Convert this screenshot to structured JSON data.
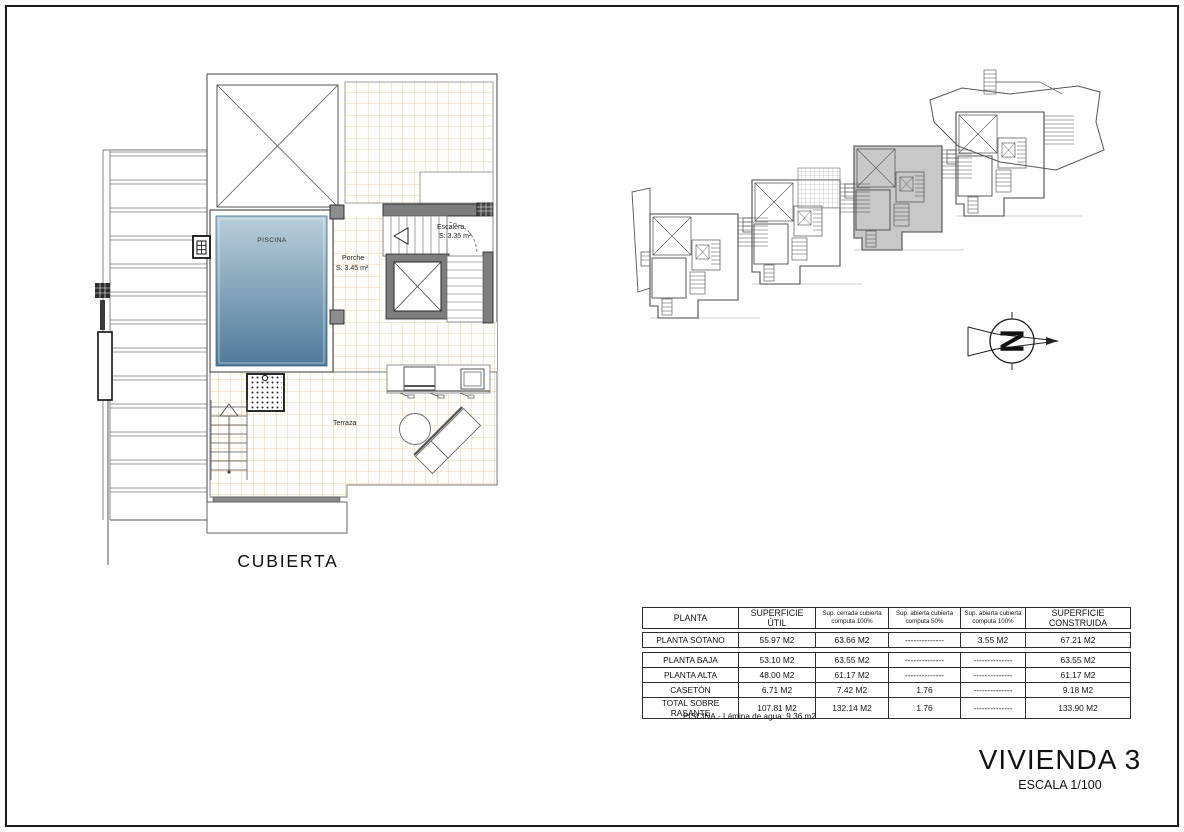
{
  "plan": {
    "labels": {
      "piscina": "PISCINA",
      "escalera": "Escalera",
      "escalera_area": "S: 3.35 m²",
      "porche": "Porche",
      "porche_area": "S: 3.45 m²",
      "terraza": "Terraza",
      "cubierta": "CUBIERTA"
    }
  },
  "colors": {
    "pool_top": "#b9cfda",
    "pool_bottom": "#4f7a9a",
    "tile_line": "#e2c49a",
    "wall_gray": "#7d7d7d",
    "unit_highlight": "#c8c8c8"
  },
  "north": {
    "letter": "N"
  },
  "site_plan": {
    "unit_count": 4,
    "highlighted_unit_index": 3
  },
  "table": {
    "headers": [
      "PLANTA",
      "SUPERFICIE ÚTIL",
      "Sup. cerrada cubierta\ncomputa 100%",
      "Sup. abierta cubierta\ncomputa 50%",
      "Sup. abierta cubierta\ncomputa 100%",
      "SUPERFICIE CONSTRUIDA"
    ],
    "basement_row": [
      "PLANTA SÓTANO",
      "55.97 M2",
      "63.66 M2",
      "--------------",
      "3.55 M2",
      "67.21 M2"
    ],
    "rows": [
      [
        "PLANTA BAJA",
        "53.10 M2",
        "63.55 M2",
        "--------------",
        "--------------",
        "63.55 M2"
      ],
      [
        "PLANTA ALTA",
        "48.00 M2",
        "61.17 M2",
        "--------------",
        "--------------",
        "61.17 M2"
      ],
      [
        "CASETÓN",
        "6.71 M2",
        "7.42 M2",
        "1.76",
        "--------------",
        "9.18 M2"
      ],
      [
        "TOTAL SOBRE RASANTE",
        "107.81 M2",
        "132.14 M2",
        "1.76",
        "--------------",
        "133.90 M2"
      ]
    ],
    "footnote": "PISCINA.- Lámina de agua: 9.36 m2"
  },
  "title_block": {
    "title": "VIVIENDA 3",
    "scale": "ESCALA 1/100"
  }
}
